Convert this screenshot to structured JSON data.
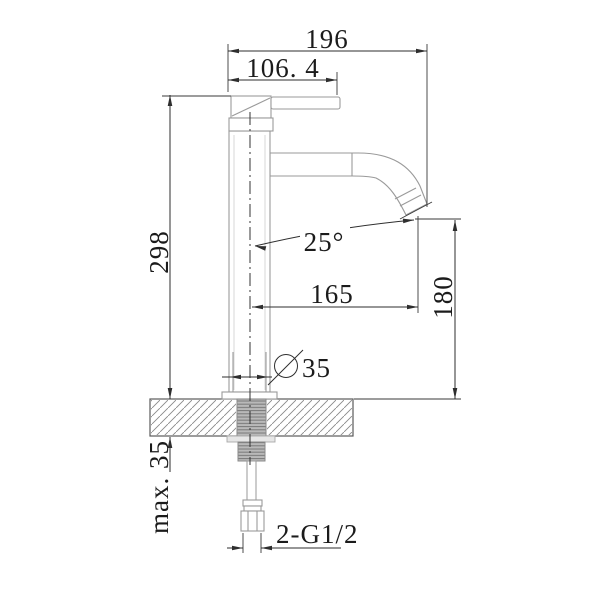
{
  "drawing": {
    "description": "faucet-technical-drawing",
    "dimensions": {
      "overall_width": "196",
      "handle_width": "106. 4",
      "body_height": "298",
      "spout_angle": "25°",
      "spout_reach": "165",
      "spout_height": "180",
      "base_diameter": {
        "symbol": "∅",
        "value": "35"
      },
      "max_deck_thickness": "max. 35",
      "inlet_thread": "2-G1/2"
    }
  }
}
